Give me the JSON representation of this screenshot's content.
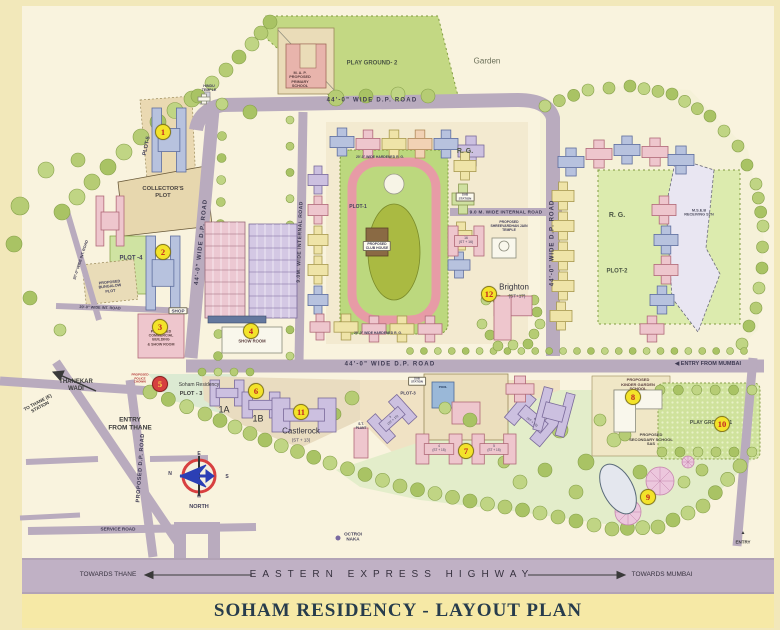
{
  "title": {
    "text": "SOHAM RESIDENCY - LAYOUT PLAN"
  },
  "colors": {
    "frame": "#f2e8ba",
    "map_bg": "#f9f3de",
    "road": "#b9abbe",
    "highway_band": "#c0b1c5",
    "title_band": "#f6e9a6",
    "marker_yellow": "#f3e32a",
    "marker_red": "#d64040",
    "marker_number_red": "#c32222",
    "green_area": "#c3d883",
    "title_text": "#273c4c"
  },
  "markers": [
    {
      "n": "1",
      "x": 163,
      "y": 132
    },
    {
      "n": "2",
      "x": 163,
      "y": 252
    },
    {
      "n": "3",
      "x": 160,
      "y": 327
    },
    {
      "n": "4",
      "x": 251,
      "y": 331
    },
    {
      "n": "5",
      "x": 160,
      "y": 384,
      "variant": "red"
    },
    {
      "n": "6",
      "x": 256,
      "y": 391
    },
    {
      "n": "7",
      "x": 466,
      "y": 451
    },
    {
      "n": "8",
      "x": 633,
      "y": 397
    },
    {
      "n": "9",
      "x": 648,
      "y": 497
    },
    {
      "n": "10",
      "x": 722,
      "y": 424
    },
    {
      "n": "11",
      "x": 301,
      "y": 412
    },
    {
      "n": "12",
      "x": 489,
      "y": 294
    }
  ],
  "labels": [
    {
      "id": "road-dp-top",
      "t": "44'-0\" WIDE D.P. ROAD",
      "x": 372,
      "y": 101,
      "fs": 6,
      "s": 1.2,
      "c": "#3e3a52"
    },
    {
      "id": "road-dp-left",
      "t": "44'-0\" WIDE D.P. ROAD",
      "x": 202,
      "y": 242,
      "fs": 6,
      "r": -84,
      "s": 1,
      "c": "#3e3a52"
    },
    {
      "id": "road-dp-right",
      "t": "44'-0\" WIDE D.P. ROAD",
      "x": 553,
      "y": 243,
      "fs": 6,
      "r": -90,
      "s": 1,
      "c": "#3e3a52"
    },
    {
      "id": "road-dp-mid",
      "t": "44'-0\" WIDE D.P. ROAD",
      "x": 390,
      "y": 365,
      "fs": 6,
      "s": 1.2,
      "c": "#3e3a52"
    },
    {
      "id": "road-internal-v",
      "t": "9.0M. WIDE INTERNAL ROAD",
      "x": 301,
      "y": 242,
      "fs": 5,
      "r": -88,
      "s": 0.5,
      "c": "#3e3a52"
    },
    {
      "id": "road-internal-h",
      "t": "9.0 M. WIDE INTERNAL ROAD",
      "x": 506,
      "y": 212,
      "fs": 4.6,
      "s": 0.3,
      "c": "#3e3a52"
    },
    {
      "id": "road-proposed-dp",
      "t": "PROPOSED D.P. ROAD",
      "x": 141,
      "y": 468,
      "fs": 5.5,
      "r": -86,
      "s": 0.5,
      "c": "#3e3a52"
    },
    {
      "id": "road-service",
      "t": "SERVICE ROAD",
      "x": 118,
      "y": 529,
      "fs": 4.6,
      "c": "#3e3a52"
    },
    {
      "id": "road-int-20a",
      "t": "20'-0\" WIDE INT. ROAD",
      "x": 81,
      "y": 260,
      "fs": 3.8,
      "r": -72,
      "c": "#3e3a52"
    },
    {
      "id": "road-int-20b",
      "t": "20'-0\" WIDE INT. ROAD",
      "x": 100,
      "y": 308,
      "fs": 3.8,
      "r": 2,
      "c": "#3e3a52"
    },
    {
      "id": "entry-from-mumbai",
      "t": "◀  ENTRY FROM MUMBAI",
      "x": 708,
      "y": 364,
      "fs": 5.5,
      "c": "#3e3a52"
    },
    {
      "id": "entry-from-thane",
      "t": "ENTRY\nFROM THANE",
      "x": 130,
      "y": 424,
      "fs": 6.5,
      "c": "#3a3a3a"
    },
    {
      "id": "entry-se",
      "t": "ENTRY",
      "x": 743,
      "y": 542,
      "fs": 4.5,
      "c": "#3a3a3a"
    },
    {
      "id": "entry-se-arrow",
      "t": "▲",
      "x": 743,
      "y": 534,
      "fs": 5,
      "c": "#3a3a3a"
    },
    {
      "id": "playground-2",
      "t": "PLAY GROUND- 2",
      "x": 372,
      "y": 64,
      "fs": 6,
      "c": "#4c5744"
    },
    {
      "id": "garden",
      "t": "Garden",
      "x": 487,
      "y": 61,
      "fs": 8,
      "w": 400,
      "c": "#6b6f58"
    },
    {
      "id": "map-school",
      "t": "M. A. P.\nPROPOSED\nPRIMARY\nSCHOOL",
      "x": 300,
      "y": 80,
      "fs": 3.8,
      "c": "#5a3e3e"
    },
    {
      "id": "hindu-temple",
      "t": "HINDU\nTEMPLE",
      "x": 209,
      "y": 88,
      "fs": 3.6
    },
    {
      "id": "plot-5",
      "t": "PLOT-5",
      "x": 147,
      "y": 146,
      "fs": 5.5,
      "r": -78
    },
    {
      "id": "collectors-plot",
      "t": "COLLECTOR'S\nPLOT",
      "x": 163,
      "y": 193,
      "fs": 5.8,
      "c": "#4a4440"
    },
    {
      "id": "plot-4",
      "t": "PLOT -4",
      "x": 131,
      "y": 259,
      "fs": 6
    },
    {
      "id": "bungalow-plot",
      "t": "PROPOSED\nBUNGALOW\nPLOT",
      "x": 110,
      "y": 287,
      "fs": 3.8,
      "r": -6
    },
    {
      "id": "shop",
      "t": "SHOP",
      "x": 178,
      "y": 311,
      "fs": 4.6,
      "chip": true
    },
    {
      "id": "commercial-bldg",
      "t": "PROPOSED\nCOMMERCIAL\nBUILDING\n& SHOW ROOM",
      "x": 161,
      "y": 338,
      "fs": 3.6,
      "c": "#5a3e3e"
    },
    {
      "id": "show-room",
      "t": "SHOW ROOM",
      "x": 252,
      "y": 342,
      "fs": 4.2,
      "c": "#5a3e3e"
    },
    {
      "id": "rg-west",
      "t": "R. G.",
      "x": 465,
      "y": 152,
      "fs": 7,
      "c": "#4c5744"
    },
    {
      "id": "sub-station-west",
      "t": "SUB\nSTATION",
      "x": 465,
      "y": 197,
      "fs": 3,
      "chip": true
    },
    {
      "id": "jain-temple",
      "t": "PROPOSED\nSHREEVARDHAN JAIN\nTEMPLE",
      "x": 509,
      "y": 226,
      "fs": 3.4
    },
    {
      "id": "brighton",
      "t": "Brighton",
      "x": 514,
      "y": 287,
      "fs": 8,
      "w": 400,
      "c": "#33323e"
    },
    {
      "id": "brighton-st",
      "t": "(ST+17)",
      "x": 517,
      "y": 296,
      "fs": 4.6,
      "w": 400
    },
    {
      "id": "bldg-16",
      "t": "16\n(ST + 16)",
      "x": 466,
      "y": 240,
      "fs": 3.4,
      "w": 400
    },
    {
      "id": "rg-east",
      "t": "R. G.",
      "x": 617,
      "y": 216,
      "fs": 7,
      "c": "#4c5744"
    },
    {
      "id": "plot-2",
      "t": "PLOT-2",
      "x": 617,
      "y": 272,
      "fs": 6,
      "c": "#4c5744"
    },
    {
      "id": "mseb",
      "t": "M.S.E.B\nRECEIVING STN",
      "x": 699,
      "y": 213,
      "fs": 3.8,
      "c": "#4c4c5e"
    },
    {
      "id": "plot-1",
      "t": "PLOT-1",
      "x": 358,
      "y": 208,
      "fs": 5
    },
    {
      "id": "club-house",
      "t": "PROPOSED\nCLUB HOUSE",
      "x": 377,
      "y": 246,
      "fs": 3.4,
      "chip": true
    },
    {
      "id": "hardened-rg-top",
      "t": "20'-0\" WIDE HARDENED R. G.",
      "x": 380,
      "y": 157,
      "fs": 3.4
    },
    {
      "id": "hardened-rg-bottom",
      "t": "20'-0\" WIDE HARDENED R. G.",
      "x": 378,
      "y": 333,
      "fs": 3.4
    },
    {
      "id": "police-chowki",
      "t": "PROPOSED\nPOLICE\nCHOWKI",
      "x": 140,
      "y": 379,
      "fs": 3,
      "c": "#b03030"
    },
    {
      "id": "soham-residency",
      "t": "Soham Residency",
      "x": 199,
      "y": 386,
      "fs": 5,
      "w": 400,
      "c": "#3a3a3a"
    },
    {
      "id": "plot-3",
      "t": "PLOT - 3",
      "x": 191,
      "y": 394,
      "fs": 5.5,
      "c": "#3a3a3a"
    },
    {
      "id": "bldg-1a",
      "t": "1A",
      "x": 224,
      "y": 410,
      "fs": 9,
      "w": 400,
      "c": "#2e2e2e"
    },
    {
      "id": "bldg-1b",
      "t": "1B",
      "x": 258,
      "y": 419,
      "fs": 9,
      "w": 400,
      "c": "#2e2e2e"
    },
    {
      "id": "castlerock",
      "t": "Castlerock",
      "x": 301,
      "y": 431,
      "fs": 8,
      "w": 400,
      "c": "#33323e"
    },
    {
      "id": "castlerock-st",
      "t": "(ST + 13)",
      "x": 301,
      "y": 440,
      "fs": 4.4,
      "w": 400
    },
    {
      "id": "st-plant",
      "t": "S.T.\nPLANT",
      "x": 361,
      "y": 427,
      "fs": 3.2
    },
    {
      "id": "plot-3-east",
      "t": "PLOT-3",
      "x": 408,
      "y": 393,
      "fs": 4.4
    },
    {
      "id": "sub-station-east",
      "t": "SUB\nSTATION",
      "x": 417,
      "y": 381,
      "fs": 2.8,
      "chip": true
    },
    {
      "id": "pool",
      "t": "POOL",
      "x": 443,
      "y": 388,
      "fs": 3,
      "c": "#223a5e"
    },
    {
      "id": "st15-3",
      "t": "3\n(ST + 15)",
      "x": 392,
      "y": 419,
      "fs": 3.2,
      "r": -42,
      "w": 400
    },
    {
      "id": "st15-4",
      "t": "4\n(ST + 15)",
      "x": 439,
      "y": 449,
      "fs": 3.2,
      "w": 400
    },
    {
      "id": "st15-5",
      "t": "5\n(ST + 15)",
      "x": 494,
      "y": 449,
      "fs": 3.2,
      "w": 400
    },
    {
      "id": "st15-6",
      "t": "6\n(ST + 15)",
      "x": 533,
      "y": 421,
      "fs": 3.2,
      "r": 40,
      "w": 400
    },
    {
      "id": "kinder-school",
      "t": "PROPOSED\nKINDER GARDEN\nSCHOOL",
      "x": 638,
      "y": 385,
      "fs": 4,
      "c": "#5a3e3e"
    },
    {
      "id": "secondary-school",
      "t": "PROPOSED\nSECONDARY SCHOOL\nSAS",
      "x": 651,
      "y": 440,
      "fs": 4,
      "c": "#4a4440"
    },
    {
      "id": "playground-1",
      "t": "PLAY GROUND -1",
      "x": 711,
      "y": 424,
      "fs": 5,
      "c": "#4c5744"
    },
    {
      "id": "octroi-naka",
      "t": "OCTROI\nNAKA",
      "x": 353,
      "y": 537,
      "fs": 4.6
    },
    {
      "id": "thanekar-wadi",
      "t": "THANEKAR\nWADI",
      "x": 76,
      "y": 386,
      "fs": 6,
      "c": "#3a3a3a"
    },
    {
      "id": "to-thane-station",
      "t": "TO THANE (E)\nSTATION",
      "x": 39,
      "y": 405,
      "fs": 4.6,
      "r": -28,
      "c": "#3a3a3a"
    },
    {
      "id": "compass-e",
      "t": "E",
      "x": 199,
      "y": 455,
      "fs": 5
    },
    {
      "id": "compass-n",
      "t": "N",
      "x": 170,
      "y": 475,
      "fs": 5
    },
    {
      "id": "compass-s",
      "t": "S",
      "x": 227,
      "y": 478,
      "fs": 5
    },
    {
      "id": "compass-w",
      "t": "W",
      "x": 199,
      "y": 496,
      "fs": 4.5
    },
    {
      "id": "north",
      "t": "NORTH",
      "x": 199,
      "y": 507,
      "fs": 5.5
    },
    {
      "id": "highway-name",
      "t": "EASTERN EXPRESS HIGHWAY",
      "x": 392,
      "y": 575,
      "fs": 10,
      "s": 6,
      "w": 500,
      "c": "#36313e"
    },
    {
      "id": "towards-thane",
      "t": "TOWARDS THANE",
      "x": 108,
      "y": 575,
      "fs": 6.5,
      "w": 400,
      "c": "#36313e"
    },
    {
      "id": "towards-mumbai",
      "t": "TOWARDS MUMBAI",
      "x": 662,
      "y": 575,
      "fs": 6.5,
      "w": 400,
      "c": "#36313e"
    }
  ]
}
